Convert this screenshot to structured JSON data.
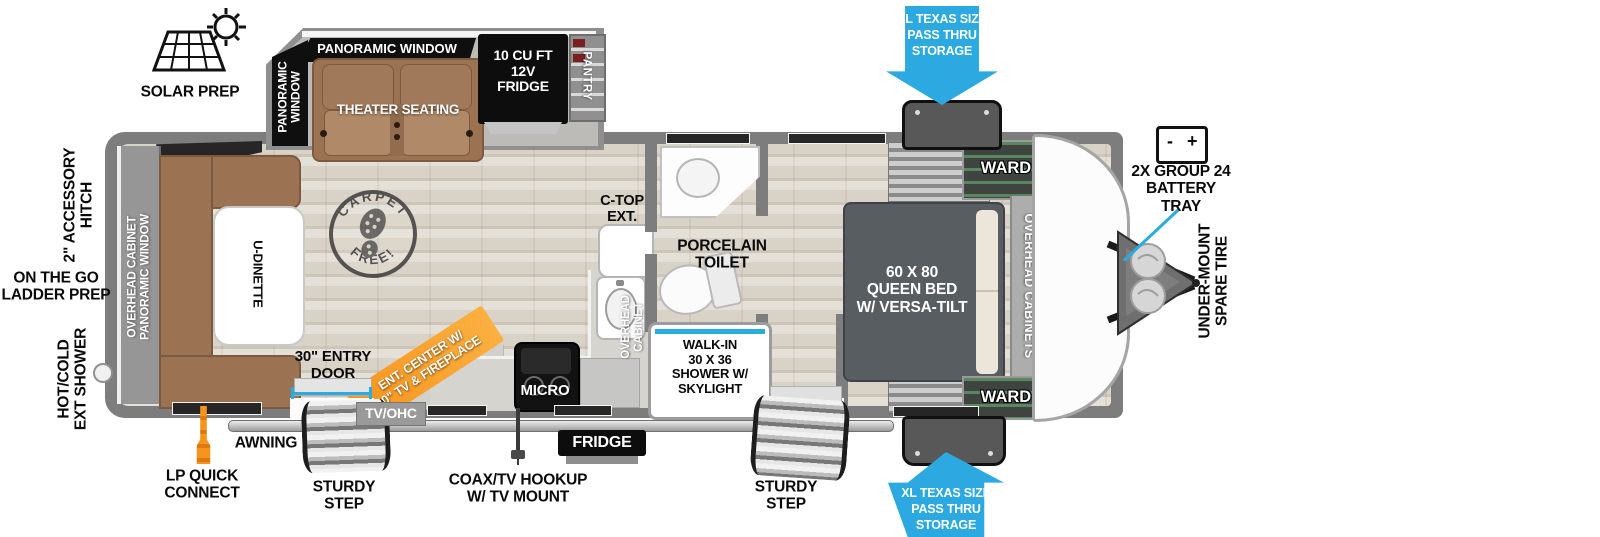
{
  "colors": {
    "pass_thru_arrow": "#2BA9E0",
    "measure_line": "#29ABE2",
    "ent_center_ribbon": "#F7941E",
    "wall_gray": "#7D7D7D",
    "wood_floor": "#D9D2C6",
    "furniture_brown": "#9C7352",
    "bed_gray": "#585D62"
  },
  "slideout": {
    "panoramic_window_top": "PANORAMIC WINDOW",
    "panoramic_window_side": "PANORAMIC\nWINDOW",
    "theater_seating": "THEATER SEATING",
    "fridge_12v": "10 CU FT\n12V\nFRIDGE",
    "pantry": "PANTRY"
  },
  "rear": {
    "overhead_cabinet_panoramic_window": "OVERHEAD CABINET\nPANORAMIC WINDOW",
    "u_dinette": "U-DINETTE",
    "carpet_free_top": "CARPET",
    "carpet_free_bottom": "FREE!"
  },
  "kitchen": {
    "ent_center": "ENT. CENTER W/\n40\" TV & FIREPLACE",
    "tv_ohc": "TV/OHC",
    "micro": "MICRO",
    "c_top_ext": "C-TOP\nEXT.",
    "overhead_cabinet": "OVERHEAD\nCABINET",
    "fridge": "FRIDGE"
  },
  "bath": {
    "porcelain_toilet": "PORCELAIN\nTOILET",
    "walk_in_shower": "WALK-IN\n30 X 36\nSHOWER W/\nSKYLIGHT"
  },
  "bedroom": {
    "queen_bed": "60 X 80\nQUEEN BED\nW/ VERSA-TILT",
    "ward_top": "WARD",
    "ward_bottom": "WARD",
    "overhead_cabinets": "OVERHEAD CABINETS"
  },
  "callouts": {
    "solar_prep": "SOLAR PREP",
    "accessory_hitch": "2\" ACCESSORY\nHITCH",
    "ladder_prep": "ON THE GO\nLADDER PREP",
    "ext_shower": "HOT/COLD\nEXT SHOWER",
    "lp_quick_connect": "LP QUICK\nCONNECT",
    "awning": "AWNING",
    "entry_door": "30\" ENTRY\nDOOR",
    "sturdy_step_left": "STURDY\nSTEP",
    "coax_tv": "COAX/TV HOOKUP\nW/ TV MOUNT",
    "sturdy_step_right": "STURDY\nSTEP",
    "pass_thru_top": "XL TEXAS SIZE\nPASS THRU\nSTORAGE",
    "pass_thru_bottom": "XL TEXAS SIZE\nPASS THRU\nSTORAGE",
    "battery_tray": "2X GROUP 24\nBATTERY\nTRAY",
    "battery_minus": "-",
    "battery_plus": "+",
    "under_mount_spare_tire": "UNDER-MOUNT\nSPARE TIRE"
  }
}
